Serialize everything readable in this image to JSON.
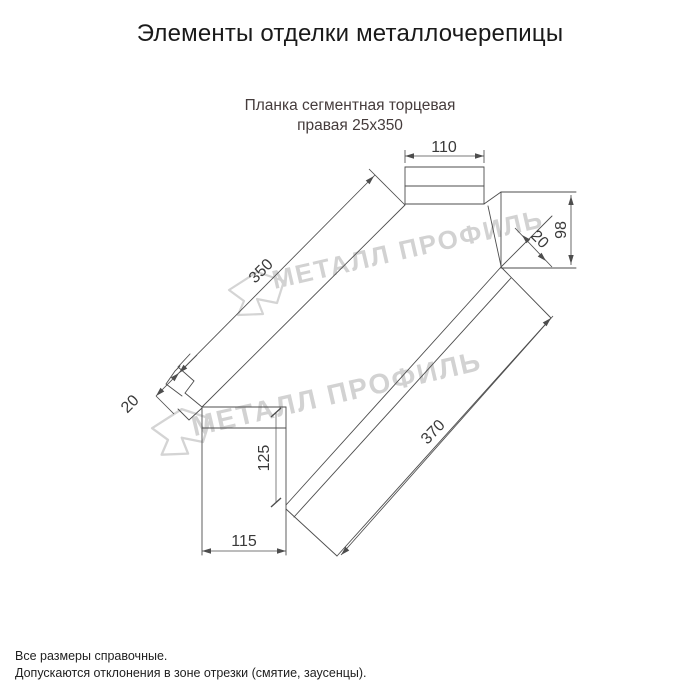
{
  "page": {
    "title": "Элементы отделки металлочерепицы"
  },
  "product": {
    "subtitle_line1": "Планка сегментная торцевая",
    "subtitle_line2": "правая 25х350"
  },
  "dimensions": {
    "flange_top_width": "110",
    "length_top": "350",
    "hem_left": "20",
    "end_height": "98",
    "hem_right": "20",
    "face_height": "125",
    "length_bottom": "370",
    "flange_bottom_width": "115"
  },
  "watermark": {
    "text": "МЕТАЛЛ ПРОФИЛЬ",
    "color": "#d2d2d2"
  },
  "footer": {
    "line1": "Все размеры справочные.",
    "line2": "Допускаются отклонения в зоне отрезки (смятие, заусенцы)."
  },
  "colors": {
    "line": "#4d4d4d",
    "title": "#1a1a1a",
    "subtitle": "#453c3c",
    "background": "#ffffff"
  }
}
